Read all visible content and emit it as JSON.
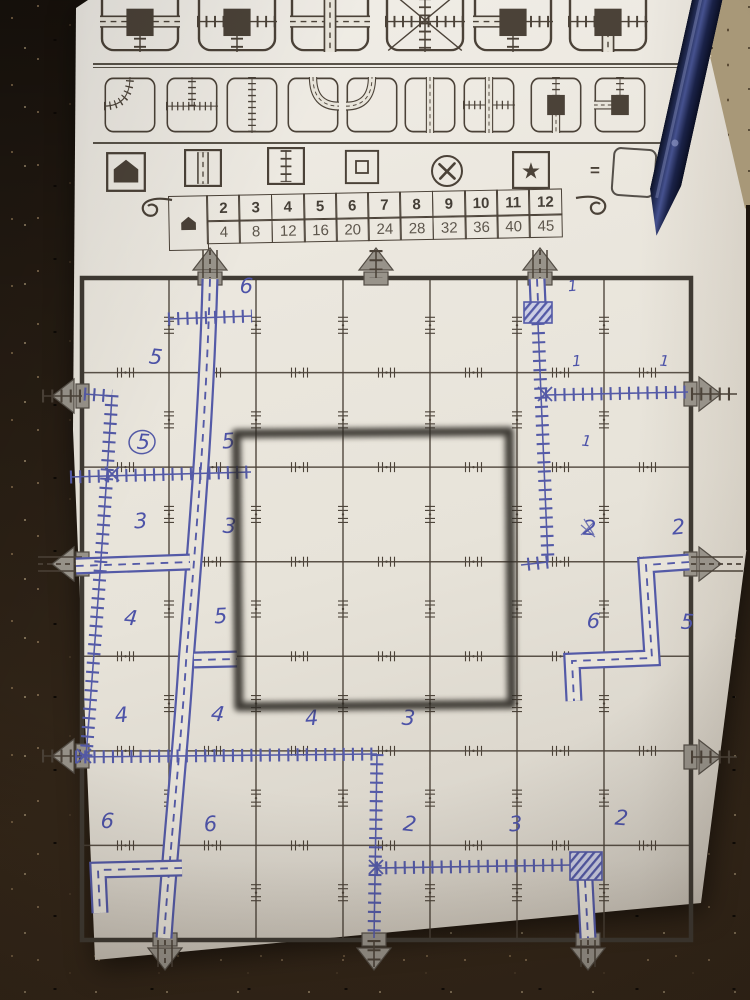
{
  "colors": {
    "paper": "#e8e4da",
    "ink": "#4b4238",
    "ink_dark": "#3f3a33",
    "blue": "#545aa7",
    "exit_fill": "#98938a",
    "exit_stroke": "#534d45",
    "square_object": "#2e2a25"
  },
  "scene": {
    "objects": [
      "ballpoint-pen",
      "granite-countertop",
      "square-frame-overlay",
      "game-sheet"
    ]
  },
  "legend": {
    "dice_top": [
      {
        "name": "station-road-we-rail-s",
        "square": true,
        "paths": [
          {
            "k": "road",
            "d": "M0,60 H100"
          },
          {
            "k": "rail",
            "d": "M50,60 V100"
          }
        ]
      },
      {
        "name": "station-rail-we-rail-s",
        "square": true,
        "paths": [
          {
            "k": "rail",
            "d": "M0,60 H100"
          },
          {
            "k": "rail",
            "d": "M50,60 V100"
          }
        ]
      },
      {
        "name": "road-crossroads",
        "square": false,
        "paths": [
          {
            "k": "road",
            "d": "M0,60 H100"
          },
          {
            "k": "road",
            "d": "M50,8 V100"
          }
        ]
      },
      {
        "name": "rail-crossroads-diagonals",
        "square": false,
        "diag": true,
        "paths": [
          {
            "k": "rail",
            "d": "M0,60 H100"
          },
          {
            "k": "rail",
            "d": "M50,8 V100"
          }
        ]
      },
      {
        "name": "station-road-w-rail-e-rail-s",
        "square": true,
        "paths": [
          {
            "k": "road",
            "d": "M0,60 H50"
          },
          {
            "k": "rail",
            "d": "M50,60 H100"
          },
          {
            "k": "rail",
            "d": "M50,60 V100"
          }
        ]
      },
      {
        "name": "station-rail-we-road-s",
        "square": true,
        "paths": [
          {
            "k": "rail",
            "d": "M0,60 H100"
          },
          {
            "k": "road",
            "d": "M50,60 V100"
          }
        ]
      }
    ],
    "dice_bottom": [
      {
        "name": "rail-curve-wn",
        "paths": [
          {
            "k": "rail",
            "d": "M0,52 Q50,52 50,0"
          }
        ]
      },
      {
        "name": "rail-tee-wen",
        "paths": [
          {
            "k": "rail",
            "d": "M0,52 H100"
          },
          {
            "k": "rail",
            "d": "M50,52 V0"
          }
        ]
      },
      {
        "name": "rail-straight-ns",
        "paths": [
          {
            "k": "rail",
            "d": "M50,0 V100"
          }
        ]
      },
      {
        "name": "road-curve-ne",
        "paths": [
          {
            "k": "road",
            "d": "M50,0 Q50,52 100,52"
          }
        ]
      },
      {
        "name": "road-curve-wn",
        "paths": [
          {
            "k": "road",
            "d": "M0,52 Q50,52 50,0"
          }
        ]
      },
      {
        "name": "road-straight-ns",
        "paths": [
          {
            "k": "road",
            "d": "M50,0 V100"
          }
        ]
      },
      {
        "name": "overpass-road-ns-rail-we",
        "paths": [
          {
            "k": "rail",
            "d": "M0,50 H100"
          },
          {
            "k": "road",
            "d": "M50,0 V100"
          }
        ]
      },
      {
        "name": "station-rail-n-road-s",
        "square": true,
        "paths": [
          {
            "k": "rail",
            "d": "M50,0 V50"
          },
          {
            "k": "road",
            "d": "M50,50 V100"
          }
        ]
      },
      {
        "name": "station-road-w-rail-n",
        "square": true,
        "paths": [
          {
            "k": "road",
            "d": "M0,50 H50"
          },
          {
            "k": "rail",
            "d": "M50,0 V50"
          }
        ]
      }
    ],
    "symbols": [
      {
        "type": "house",
        "name": "exit-house-symbol"
      },
      {
        "type": "road",
        "name": "road-symbol"
      },
      {
        "type": "rail",
        "name": "rail-symbol"
      },
      {
        "type": "square",
        "name": "station-square-symbol"
      },
      {
        "type": "x",
        "name": "crossing-x-symbol"
      },
      {
        "type": "star",
        "name": "star-symbol"
      }
    ],
    "equals_sign": "="
  },
  "score_table": {
    "house_icon": "exit-house",
    "columns": [
      "2",
      "3",
      "4",
      "5",
      "6",
      "7",
      "8",
      "9",
      "10",
      "11",
      "12"
    ],
    "values": [
      "4",
      "8",
      "12",
      "16",
      "20",
      "24",
      "28",
      "32",
      "36",
      "40",
      "45"
    ]
  },
  "board": {
    "grid": {
      "cols": 7,
      "rows": 7,
      "x": 82,
      "y": 278,
      "w": 609,
      "h": 662
    },
    "exits": [
      {
        "side": "top",
        "pos": 210,
        "type": "road"
      },
      {
        "side": "top",
        "pos": 376,
        "type": "rail"
      },
      {
        "side": "top",
        "pos": 540,
        "type": "road"
      },
      {
        "side": "left",
        "pos": 396,
        "type": "rail"
      },
      {
        "side": "left",
        "pos": 564,
        "type": "road"
      },
      {
        "side": "left",
        "pos": 756,
        "type": "rail"
      },
      {
        "side": "right",
        "pos": 394,
        "type": "rail"
      },
      {
        "side": "right",
        "pos": 564,
        "type": "road"
      },
      {
        "side": "right",
        "pos": 757,
        "type": "rail"
      },
      {
        "side": "bottom",
        "pos": 165,
        "type": "road"
      },
      {
        "side": "bottom",
        "pos": 374,
        "type": "rail"
      },
      {
        "side": "bottom",
        "pos": 588,
        "type": "road"
      }
    ],
    "center_square": {
      "x": 233,
      "y": 428,
      "size": 282
    },
    "routes": [
      {
        "kind": "road",
        "d": "M210,279 C206,430 193,570 186,662 C181,745 170,848 164,938"
      },
      {
        "kind": "road",
        "d": "M76,566 L190,562"
      },
      {
        "kind": "road",
        "d": "M194,660 L237,659"
      },
      {
        "kind": "road",
        "d": "M537,279 L538,302"
      },
      {
        "kind": "road",
        "d": "M585,880 L588,938"
      },
      {
        "kind": "road",
        "d": "M689,562 L646,565 L652,658 L572,661 L574,701"
      },
      {
        "kind": "road",
        "d": "M182,868 L98,870 L100,913"
      },
      {
        "kind": "rail",
        "d": "M84,394 L112,396"
      },
      {
        "kind": "rail",
        "d": "M112,395 C105,510 96,630 86,756"
      },
      {
        "kind": "rail",
        "d": "M70,477 L251,472"
      },
      {
        "kind": "rail",
        "d": "M75,757 L377,754"
      },
      {
        "kind": "rail",
        "d": "M377,754 L374,938"
      },
      {
        "kind": "rail",
        "d": "M376,868 L572,865"
      },
      {
        "kind": "rail",
        "d": "M168,319 L252,316"
      },
      {
        "kind": "rail",
        "d": "M538,323 C541,400 545,480 548,562"
      },
      {
        "kind": "rail",
        "d": "M548,562 L521,565"
      },
      {
        "kind": "rail",
        "d": "M545,395 L688,392"
      }
    ],
    "stations": [
      {
        "x": 524,
        "y": 302,
        "w": 28,
        "h": 21
      },
      {
        "x": 570,
        "y": 852,
        "w": 32,
        "h": 28
      }
    ],
    "junctions": [
      [
        112,
        474
      ],
      [
        84,
        756
      ],
      [
        545,
        394
      ],
      [
        376,
        867
      ]
    ],
    "numbers": [
      {
        "v": "6",
        "x": 246,
        "y": 293
      },
      {
        "v": "1",
        "x": 573,
        "y": 291
      },
      {
        "v": "5",
        "x": 155,
        "y": 364
      },
      {
        "v": "1",
        "x": 577,
        "y": 366
      },
      {
        "v": "1",
        "x": 664,
        "y": 366
      },
      {
        "v": "5",
        "x": 143,
        "y": 449,
        "circle": true
      },
      {
        "v": "5",
        "x": 229,
        "y": 448
      },
      {
        "v": "1",
        "x": 586,
        "y": 446
      },
      {
        "v": "3",
        "x": 141,
        "y": 528
      },
      {
        "v": "3",
        "x": 229,
        "y": 533
      },
      {
        "v": "2",
        "x": 589,
        "y": 535,
        "scratch": true
      },
      {
        "v": "2",
        "x": 679,
        "y": 534
      },
      {
        "v": "4",
        "x": 130,
        "y": 625
      },
      {
        "v": "5",
        "x": 221,
        "y": 623
      },
      {
        "v": "6",
        "x": 593,
        "y": 628
      },
      {
        "v": "5",
        "x": 687,
        "y": 629
      },
      {
        "v": "4",
        "x": 122,
        "y": 722
      },
      {
        "v": "4",
        "x": 217,
        "y": 721
      },
      {
        "v": "4",
        "x": 312,
        "y": 725
      },
      {
        "v": "3",
        "x": 408,
        "y": 725
      },
      {
        "v": "6",
        "x": 107,
        "y": 828
      },
      {
        "v": "6",
        "x": 211,
        "y": 831
      },
      {
        "v": "2",
        "x": 409,
        "y": 831
      },
      {
        "v": "3",
        "x": 516,
        "y": 831
      },
      {
        "v": "2",
        "x": 621,
        "y": 825
      }
    ]
  }
}
